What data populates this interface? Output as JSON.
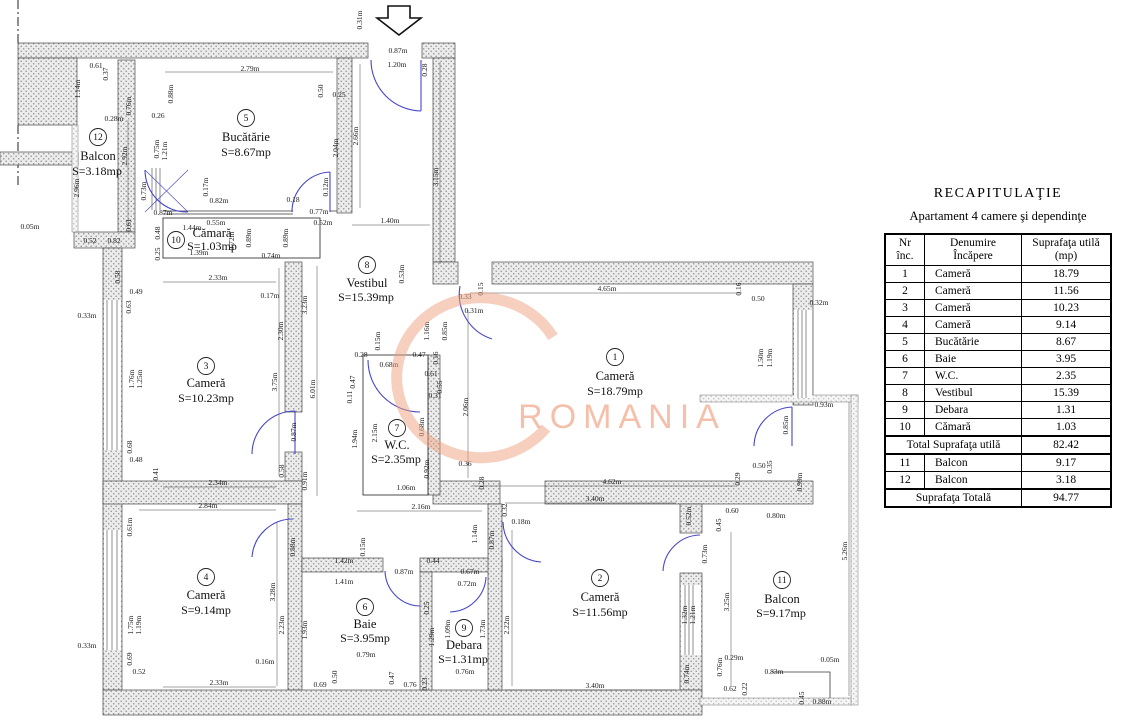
{
  "table": {
    "title": "RECAPITULAŢIE",
    "subtitle": "Apartament 4 camere şi dependinţe",
    "col_headers": {
      "nr": [
        "Nr",
        "înc."
      ],
      "name": [
        "Denumire",
        "Încăpere"
      ],
      "area": [
        "Suprafaţa utilă",
        "(mp)"
      ]
    },
    "rows": [
      [
        "1",
        "Cameră",
        "18.79"
      ],
      [
        "2",
        "Cameră",
        "11.56"
      ],
      [
        "3",
        "Cameră",
        "10.23"
      ],
      [
        "4",
        "Cameră",
        "9.14"
      ],
      [
        "5",
        "Bucătărie",
        "8.67"
      ],
      [
        "6",
        "Baie",
        "3.95"
      ],
      [
        "7",
        "W.C.",
        "2.35"
      ],
      [
        "8",
        "Vestibul",
        "15.39"
      ],
      [
        "9",
        "Debara",
        "1.31"
      ],
      [
        "10",
        "Cămară",
        "1.03"
      ]
    ],
    "total_util": {
      "label": "Total Suprafaţa utilă",
      "value": "82.42"
    },
    "balcony_rows": [
      [
        "11",
        "Balcon",
        "9.17"
      ],
      [
        "12",
        "Balcon",
        "3.18"
      ]
    ],
    "total": {
      "label": "Suprafaţa Totală",
      "value": "94.77"
    }
  },
  "plan": {
    "watermark": {
      "text": "ROMANIA",
      "text_color": "#f1a88b",
      "swoosh_color": "#eda07e"
    },
    "rooms": [
      {
        "id": "1",
        "name": "Cameră",
        "area": "S=18.79mp",
        "nx": 615,
        "ny": 357,
        "mx": 615,
        "my": 380,
        "ax": 615,
        "ay": 395
      },
      {
        "id": "2",
        "name": "Cameră",
        "area": "S=11.56mp",
        "nx": 600,
        "ny": 578,
        "mx": 600,
        "my": 601,
        "ax": 600,
        "ay": 616
      },
      {
        "id": "3",
        "name": "Cameră",
        "area": "S=10.23mp",
        "nx": 206,
        "ny": 366,
        "mx": 206,
        "my": 387,
        "ax": 206,
        "ay": 402
      },
      {
        "id": "4",
        "name": "Cameră",
        "area": "S=9.14mp",
        "nx": 206,
        "ny": 577,
        "mx": 206,
        "my": 599,
        "ax": 206,
        "ay": 614
      },
      {
        "id": "5",
        "name": "Bucătărie",
        "area": "S=8.67mp",
        "nx": 246,
        "ny": 118,
        "mx": 246,
        "my": 141,
        "ax": 246,
        "ay": 156
      },
      {
        "id": "6",
        "name": "Baie",
        "area": "S=3.95mp",
        "nx": 365,
        "ny": 607,
        "mx": 365,
        "my": 628,
        "ax": 365,
        "ay": 642
      },
      {
        "id": "7",
        "name": "W.C.",
        "area": "S=2.35mp",
        "nx": 397,
        "ny": 428,
        "mx": 397,
        "my": 449,
        "ax": 396,
        "ay": 463
      },
      {
        "id": "8",
        "name": "Vestibul",
        "area": "S=15.39mp",
        "nx": 367,
        "ny": 265,
        "mx": 367,
        "my": 287,
        "ax": 366,
        "ay": 301
      },
      {
        "id": "9",
        "name": "Debara",
        "area": "S=1.31mp",
        "nx": 464,
        "ny": 628,
        "mx": 464,
        "my": 649,
        "ax": 463,
        "ay": 663
      },
      {
        "id": "10",
        "name": "Cămară",
        "area": "S=1.03mp",
        "nx": 176,
        "ny": 240,
        "mx": 212,
        "my": 237,
        "ax": 212,
        "ay": 250
      },
      {
        "id": "11",
        "name": "Balcon",
        "area": "S=9.17mp",
        "nx": 782,
        "ny": 580,
        "mx": 782,
        "my": 603,
        "ax": 781,
        "ay": 617
      },
      {
        "id": "12",
        "name": "Balcon",
        "area": "S=3.18mp",
        "nx": 98,
        "ny": 137,
        "mx": 98,
        "my": 160,
        "ax": 97,
        "ay": 175
      }
    ],
    "dims": [
      {
        "t": "0.31m",
        "x": 362,
        "y": 20,
        "v": 1
      },
      {
        "t": "0.87m",
        "x": 398,
        "y": 53
      },
      {
        "t": "1.20m",
        "x": 397,
        "y": 67
      },
      {
        "t": "0.28",
        "x": 427,
        "y": 70,
        "v": 1
      },
      {
        "t": "0.61",
        "x": 96,
        "y": 68
      },
      {
        "t": "0.37",
        "x": 108,
        "y": 74,
        "v": 1
      },
      {
        "t": "2.79m",
        "x": 250,
        "y": 71
      },
      {
        "t": "0.88m",
        "x": 173,
        "y": 94,
        "v": 1
      },
      {
        "t": "0.50",
        "x": 323,
        "y": 91,
        "v": 1
      },
      {
        "t": "0.25",
        "x": 339,
        "y": 97
      },
      {
        "t": "1.14m",
        "x": 80,
        "y": 89,
        "v": 1
      },
      {
        "t": "0.76m",
        "x": 131,
        "y": 106,
        "v": 1
      },
      {
        "t": "0.28m",
        "x": 114,
        "y": 121
      },
      {
        "t": "0.26",
        "x": 158,
        "y": 118
      },
      {
        "t": "0.75m",
        "x": 159,
        "y": 149,
        "v": 1
      },
      {
        "t": "1.21m",
        "x": 167,
        "y": 151,
        "v": 1
      },
      {
        "t": "2.92m",
        "x": 127,
        "y": 156,
        "v": 1
      },
      {
        "t": "2.04m",
        "x": 338,
        "y": 148,
        "v": 1
      },
      {
        "t": "2.66m",
        "x": 358,
        "y": 136,
        "v": 1
      },
      {
        "t": "3.15m",
        "x": 438,
        "y": 177,
        "v": 1
      },
      {
        "t": "2.96m",
        "x": 79,
        "y": 188,
        "v": 1
      },
      {
        "t": "0.73m",
        "x": 146,
        "y": 191,
        "v": 1
      },
      {
        "t": "0.17m",
        "x": 208,
        "y": 187,
        "v": 1
      },
      {
        "t": "0.12m",
        "x": 328,
        "y": 187,
        "v": 1
      },
      {
        "t": "0.82m",
        "x": 219,
        "y": 203
      },
      {
        "t": "0.18",
        "x": 293,
        "y": 202
      },
      {
        "t": "0.87m",
        "x": 163,
        "y": 215
      },
      {
        "t": "0.77m",
        "x": 319,
        "y": 214
      },
      {
        "t": "0.52m",
        "x": 323,
        "y": 225
      },
      {
        "t": "1.40m",
        "x": 390,
        "y": 223
      },
      {
        "t": "0.05m",
        "x": 30,
        "y": 229
      },
      {
        "t": "0.61",
        "x": 131,
        "y": 225,
        "v": 1
      },
      {
        "t": "1.44m",
        "x": 192,
        "y": 230
      },
      {
        "t": "0.55m",
        "x": 216,
        "y": 225
      },
      {
        "t": "0.48",
        "x": 160,
        "y": 233,
        "v": 1
      },
      {
        "t": "0.52",
        "x": 90,
        "y": 243
      },
      {
        "t": "0.82",
        "x": 114,
        "y": 243
      },
      {
        "t": "0.72m",
        "x": 234,
        "y": 241,
        "v": 1
      },
      {
        "t": "0.89m",
        "x": 251,
        "y": 238,
        "v": 1
      },
      {
        "t": "0.89m",
        "x": 288,
        "y": 238,
        "v": 1
      },
      {
        "t": "0.25",
        "x": 160,
        "y": 254,
        "v": 1
      },
      {
        "t": "1.39m",
        "x": 199,
        "y": 255
      },
      {
        "t": "0.74m",
        "x": 271,
        "y": 258
      },
      {
        "t": "0.53m",
        "x": 404,
        "y": 274,
        "v": 1
      },
      {
        "t": "2.33m",
        "x": 218,
        "y": 280
      },
      {
        "t": "0.58",
        "x": 120,
        "y": 277,
        "v": 1
      },
      {
        "t": "0.15",
        "x": 483,
        "y": 289,
        "v": 1
      },
      {
        "t": "4.65m",
        "x": 607,
        "y": 291
      },
      {
        "t": "0.16",
        "x": 741,
        "y": 289,
        "v": 1
      },
      {
        "t": "0.49",
        "x": 136,
        "y": 294
      },
      {
        "t": "0.33",
        "x": 465,
        "y": 299
      },
      {
        "t": "0.50",
        "x": 758,
        "y": 301
      },
      {
        "t": "0.32m",
        "x": 819,
        "y": 305
      },
      {
        "t": "0.63",
        "x": 131,
        "y": 307,
        "v": 1
      },
      {
        "t": "0.17m",
        "x": 270,
        "y": 298
      },
      {
        "t": "3.23m",
        "x": 307,
        "y": 305,
        "v": 1
      },
      {
        "t": "0.31m",
        "x": 474,
        "y": 313
      },
      {
        "t": "1.16m",
        "x": 429,
        "y": 331,
        "v": 1
      },
      {
        "t": "0.85m",
        "x": 447,
        "y": 331,
        "v": 1
      },
      {
        "t": "2.30m",
        "x": 283,
        "y": 331,
        "v": 1
      },
      {
        "t": "0.15m",
        "x": 380,
        "y": 341,
        "v": 1
      },
      {
        "t": "0.28",
        "x": 361,
        "y": 357
      },
      {
        "t": "0.47",
        "x": 419,
        "y": 357
      },
      {
        "t": "0.16",
        "x": 438,
        "y": 358,
        "v": 1
      },
      {
        "t": "1.50m",
        "x": 763,
        "y": 358,
        "v": 1
      },
      {
        "t": "1.19m",
        "x": 772,
        "y": 358,
        "v": 1
      },
      {
        "t": "0.68m",
        "x": 389,
        "y": 367
      },
      {
        "t": "0.61",
        "x": 431,
        "y": 376
      },
      {
        "t": "1.76m",
        "x": 134,
        "y": 379,
        "v": 1
      },
      {
        "t": "1.25m",
        "x": 142,
        "y": 379,
        "v": 1
      },
      {
        "t": "3.75m",
        "x": 277,
        "y": 382,
        "v": 1
      },
      {
        "t": "0.47",
        "x": 355,
        "y": 382,
        "v": 1
      },
      {
        "t": "0.55",
        "x": 442,
        "y": 387,
        "v": 1
      },
      {
        "t": "6.01m",
        "x": 315,
        "y": 389,
        "v": 1
      },
      {
        "t": "0.11",
        "x": 352,
        "y": 397,
        "v": 1
      },
      {
        "t": "0.31",
        "x": 435,
        "y": 398
      },
      {
        "t": "2.06m",
        "x": 468,
        "y": 407,
        "v": 1
      },
      {
        "t": "0.93m",
        "x": 824,
        "y": 407
      },
      {
        "t": "0.85m",
        "x": 788,
        "y": 425,
        "v": 1
      },
      {
        "t": "2.15m",
        "x": 377,
        "y": 433,
        "v": 1
      },
      {
        "t": "0.68m",
        "x": 424,
        "y": 427,
        "v": 1
      },
      {
        "t": "0.87m",
        "x": 296,
        "y": 432,
        "v": 1
      },
      {
        "t": "1.94m",
        "x": 357,
        "y": 439,
        "v": 1
      },
      {
        "t": "0.68",
        "x": 132,
        "y": 447,
        "v": 1
      },
      {
        "t": "0.48",
        "x": 136,
        "y": 462
      },
      {
        "t": "0.36",
        "x": 465,
        "y": 466
      },
      {
        "t": "0.50",
        "x": 759,
        "y": 468
      },
      {
        "t": "0.35",
        "x": 772,
        "y": 467,
        "v": 1
      },
      {
        "t": "0.92m",
        "x": 429,
        "y": 469,
        "v": 1
      },
      {
        "t": "0.58",
        "x": 284,
        "y": 471,
        "v": 1
      },
      {
        "t": "0.41",
        "x": 158,
        "y": 474,
        "v": 1
      },
      {
        "t": "0.29",
        "x": 740,
        "y": 479,
        "v": 1
      },
      {
        "t": "0.99m",
        "x": 802,
        "y": 482,
        "v": 1
      },
      {
        "t": "0.28",
        "x": 484,
        "y": 483,
        "v": 1
      },
      {
        "t": "2.34m",
        "x": 218,
        "y": 485
      },
      {
        "t": "4.62m",
        "x": 612,
        "y": 484
      },
      {
        "t": "0.91m",
        "x": 307,
        "y": 481,
        "v": 1
      },
      {
        "t": "1.06m",
        "x": 406,
        "y": 490
      },
      {
        "t": "3.40m",
        "x": 595,
        "y": 501
      },
      {
        "t": "0.32",
        "x": 507,
        "y": 510,
        "v": 1
      },
      {
        "t": "2.84m",
        "x": 208,
        "y": 508
      },
      {
        "t": "2.16m",
        "x": 421,
        "y": 509
      },
      {
        "t": "0.52m",
        "x": 691,
        "y": 516,
        "v": 1
      },
      {
        "t": "0.60",
        "x": 732,
        "y": 513
      },
      {
        "t": "0.80m",
        "x": 776,
        "y": 518
      },
      {
        "t": "0.18m",
        "x": 521,
        "y": 524
      },
      {
        "t": "0.45",
        "x": 721,
        "y": 525,
        "v": 1
      },
      {
        "t": "0.61m",
        "x": 132,
        "y": 527,
        "v": 1
      },
      {
        "t": "1.14m",
        "x": 477,
        "y": 534,
        "v": 1
      },
      {
        "t": "0.87m",
        "x": 494,
        "y": 540,
        "v": 1
      },
      {
        "t": "0.88m",
        "x": 295,
        "y": 547,
        "v": 1
      },
      {
        "t": "0.15m",
        "x": 365,
        "y": 547,
        "v": 1
      },
      {
        "t": "5.26m",
        "x": 847,
        "y": 551,
        "v": 1
      },
      {
        "t": "0.73m",
        "x": 707,
        "y": 554,
        "v": 1
      },
      {
        "t": "1.42m",
        "x": 344,
        "y": 563
      },
      {
        "t": "0.44",
        "x": 433,
        "y": 563
      },
      {
        "t": "0.87m",
        "x": 404,
        "y": 574
      },
      {
        "t": "0.67m",
        "x": 470,
        "y": 574
      },
      {
        "t": "1.41m",
        "x": 344,
        "y": 584
      },
      {
        "t": "0.72m",
        "x": 467,
        "y": 586
      },
      {
        "t": "3.28m",
        "x": 275,
        "y": 592,
        "v": 1
      },
      {
        "t": "3.25m",
        "x": 729,
        "y": 602,
        "v": 1
      },
      {
        "t": "0.25",
        "x": 429,
        "y": 608,
        "v": 1
      },
      {
        "t": "1.75m",
        "x": 133,
        "y": 625,
        "v": 1
      },
      {
        "t": "1.19m",
        "x": 141,
        "y": 625,
        "v": 1
      },
      {
        "t": "2.23m",
        "x": 284,
        "y": 625,
        "v": 1
      },
      {
        "t": "2.22m",
        "x": 509,
        "y": 625,
        "v": 1
      },
      {
        "t": "1.93m",
        "x": 307,
        "y": 630,
        "v": 1
      },
      {
        "t": "1.09m",
        "x": 450,
        "y": 629,
        "v": 1
      },
      {
        "t": "1.73m",
        "x": 485,
        "y": 629,
        "v": 1
      },
      {
        "t": "1.32m",
        "x": 687,
        "y": 615,
        "v": 1
      },
      {
        "t": "1.21m",
        "x": 695,
        "y": 615,
        "v": 1
      },
      {
        "t": "1.29m",
        "x": 434,
        "y": 637,
        "v": 1
      },
      {
        "t": "0.33m",
        "x": 87,
        "y": 318
      },
      {
        "t": "0.33m",
        "x": 87,
        "y": 648
      },
      {
        "t": "0.79m",
        "x": 366,
        "y": 657
      },
      {
        "t": "0.16m",
        "x": 265,
        "y": 664
      },
      {
        "t": "0.69",
        "x": 132,
        "y": 659,
        "v": 1
      },
      {
        "t": "0.29m",
        "x": 734,
        "y": 660
      },
      {
        "t": "0.05m",
        "x": 830,
        "y": 662
      },
      {
        "t": "0.74m",
        "x": 689,
        "y": 674,
        "v": 1
      },
      {
        "t": "0.76m",
        "x": 722,
        "y": 667,
        "v": 1
      },
      {
        "t": "0.83m",
        "x": 774,
        "y": 674
      },
      {
        "t": "0.76m",
        "x": 465,
        "y": 674
      },
      {
        "t": "0.52",
        "x": 139,
        "y": 674
      },
      {
        "t": "0.50",
        "x": 337,
        "y": 677,
        "v": 1
      },
      {
        "t": "0.47",
        "x": 394,
        "y": 678,
        "v": 1
      },
      {
        "t": "0.23",
        "x": 427,
        "y": 684,
        "v": 1
      },
      {
        "t": "0.69",
        "x": 320,
        "y": 687
      },
      {
        "t": "0.76",
        "x": 410,
        "y": 687
      },
      {
        "t": "2.33m",
        "x": 219,
        "y": 685
      },
      {
        "t": "3.40m",
        "x": 595,
        "y": 688
      },
      {
        "t": "0.62",
        "x": 730,
        "y": 691
      },
      {
        "t": "0.22",
        "x": 747,
        "y": 689,
        "v": 1
      },
      {
        "t": "0.45",
        "x": 804,
        "y": 698,
        "v": 1
      },
      {
        "t": "0.88m",
        "x": 822,
        "y": 704
      }
    ]
  }
}
